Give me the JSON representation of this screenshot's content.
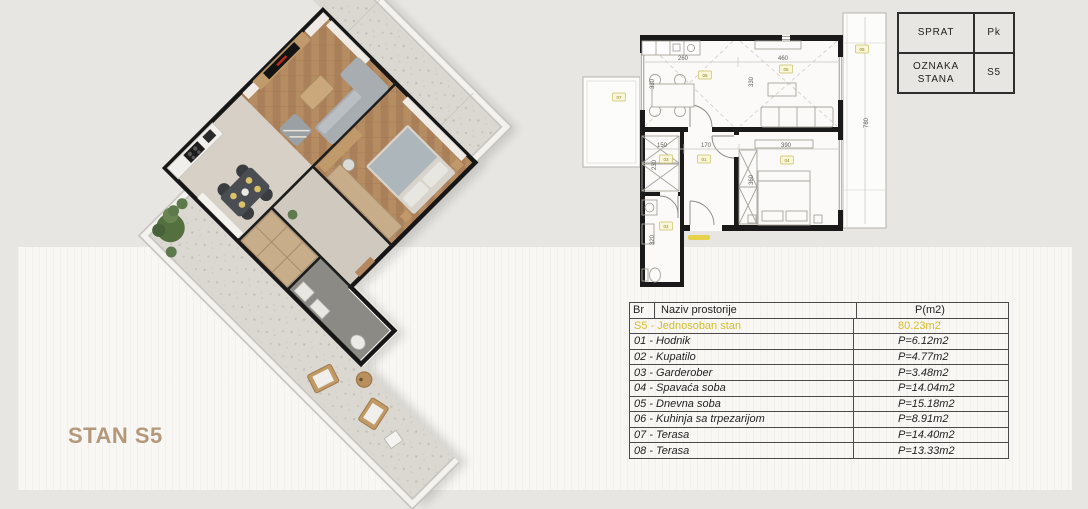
{
  "scene": {
    "background": "#e7e6e3",
    "panel_color": "#f8f7f4"
  },
  "plan3d": {
    "label": "STAN S5",
    "label_color": "#b3987a",
    "tv_accent_color": "#c42a1e"
  },
  "unit_info": {
    "floor_label": "SPRAT",
    "floor_value": "Pk",
    "unit_label": "OZNAKA STANA",
    "unit_value": "S5"
  },
  "room_table": {
    "col_br": "Br",
    "col_name": "Naziv prostorije",
    "col_area": "P(m2)",
    "summary": {
      "name": "S5 - Jednosoban stan",
      "area": "80.23m2",
      "color": "#d6bc2b"
    },
    "rows": [
      {
        "name": "01 - Hodnik",
        "area": "P=6.12m2"
      },
      {
        "name": "02 - Kupatilo",
        "area": "P=4.77m2"
      },
      {
        "name": "03 - Garderober",
        "area": "P=3.48m2"
      },
      {
        "name": "04 - Spavaća soba",
        "area": "P=14.04m2"
      },
      {
        "name": "05 - Dnevna soba",
        "area": "P=15.18m2"
      },
      {
        "name": "06 - Kuhinja sa trpezarijom",
        "area": "P=8.91m2"
      },
      {
        "name": "07 - Terasa",
        "area": "P=14.40m2"
      },
      {
        "name": "08 - Terasa",
        "area": "P=13.33m2"
      }
    ]
  },
  "plan2d": {
    "dims": {
      "kitchen_w": "260",
      "living_w": "460",
      "kitchen_d": "330",
      "living_d": "330",
      "garderober_w": "150",
      "hodnik_w": "170",
      "bedroom_w": "390",
      "garderober_d": "230",
      "bedroom_d": "360",
      "bathroom_d": "320",
      "terrace_len": "780"
    },
    "badges": [
      {
        "label": "07"
      },
      {
        "label": "06"
      },
      {
        "label": "05"
      },
      {
        "label": "08"
      },
      {
        "label": "03"
      },
      {
        "label": "01"
      },
      {
        "label": "04"
      },
      {
        "label": "02"
      }
    ]
  }
}
